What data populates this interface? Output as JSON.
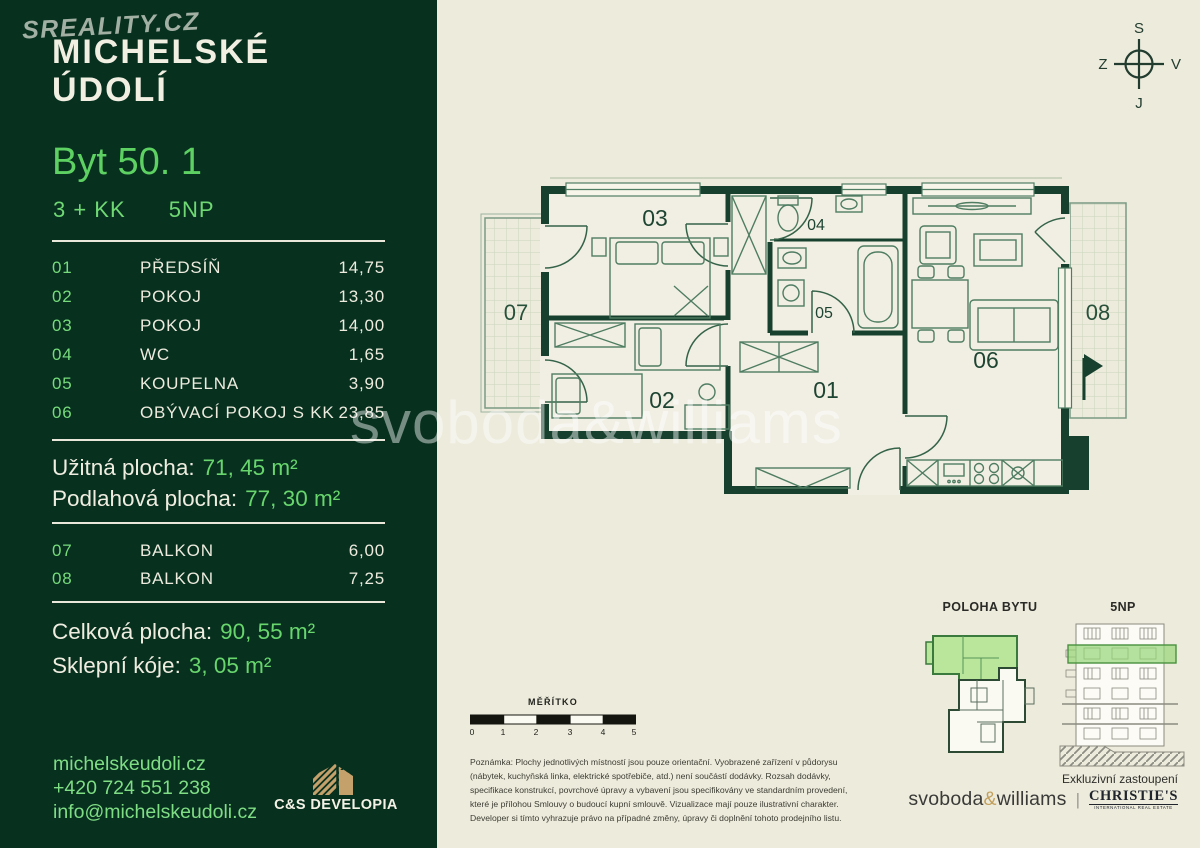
{
  "colors": {
    "sidebar_bg": "#07301F",
    "accent_green": "#5ED163",
    "light_green": "#7FDD84",
    "cream_bg": "#EDEBDC",
    "wall_green": "#17412E",
    "unit_highlight": "#B9E69B",
    "gold": "#C4A06A"
  },
  "branding": {
    "portal_logo": "SREALITY.CZ",
    "project_line1": "MICHELSKÉ",
    "project_line2": "ÚDOLÍ"
  },
  "unit": {
    "title": "Byt 50. 1",
    "disposition": "3 + KK",
    "floor": "5NP"
  },
  "room_table": {
    "rows": [
      {
        "num": "01",
        "name": "PŘEDSÍŇ",
        "area": "14,75"
      },
      {
        "num": "02",
        "name": "POKOJ",
        "area": "13,30"
      },
      {
        "num": "03",
        "name": "POKOJ",
        "area": "14,00"
      },
      {
        "num": "04",
        "name": "WC",
        "area": "1,65"
      },
      {
        "num": "05",
        "name": "KOUPELNA",
        "area": "3,90"
      },
      {
        "num": "06",
        "name": "OBÝVACÍ POKOJ S KK",
        "area": "23,85"
      }
    ]
  },
  "area_summary": {
    "usable_label": "Užitná plocha:",
    "usable_value": "71, 45 m²",
    "floor_label": "Podlahová plocha:",
    "floor_value": "77, 30 m²"
  },
  "balcony_table": {
    "rows": [
      {
        "num": "07",
        "name": "BALKON",
        "area": "6,00"
      },
      {
        "num": "08",
        "name": "BALKON",
        "area": "7,25"
      }
    ]
  },
  "totals": {
    "total_label": "Celková plocha:",
    "total_value": "90, 55 m²",
    "cellar_label": "Sklepní kóje:",
    "cellar_value": "3, 05 m²"
  },
  "contact": {
    "website": "michelskeudoli.cz",
    "phone": "+420 724 551 238",
    "email": "info@michelskeudoli.cz"
  },
  "developer_logo": "C&S DEVELOPIA",
  "compass": {
    "north": "S",
    "east": "V",
    "south": "J",
    "west": "Z"
  },
  "floor_plan": {
    "labels": {
      "r01": "01",
      "r02": "02",
      "r03": "03",
      "r04": "04",
      "r05": "05",
      "r06": "06",
      "r07": "07",
      "r08": "08"
    }
  },
  "location_diagrams": {
    "position_label": "POLOHA BYTU",
    "floor_label": "5NP"
  },
  "scale_bar": {
    "label": "MĚŘÍTKO",
    "ticks": [
      "0",
      "1",
      "2",
      "3",
      "4",
      "5"
    ]
  },
  "note": "Poznámka: Plochy jednotlivých místností jsou pouze orientační. Vyobrazené zařízení v půdorysu (nábytek, kuchyňská linka, elektrické spotřebiče, atd.) není součástí dodávky. Rozsah dodávky, specifikace konstrukcí, povrchové úpravy a vybavení jsou specifikovány ve standardním provedení, které je přílohou Smlouvy o budoucí kupní smlouvě. Vizualizace mají pouze ilustrativní charakter. Developer si tímto vyhrazuje právo na případné změny, úpravy či doplnění tohoto prodejního listu.",
  "agency": {
    "exclusive_label": "Exkluzivní zastoupení",
    "sw_part1": "svoboda",
    "sw_amp": "&",
    "sw_part2": "williams",
    "separator": "|",
    "christies": "CHRISTIE'S",
    "christies_sub": "INTERNATIONAL REAL ESTATE"
  },
  "watermark": "svoboda&williams"
}
